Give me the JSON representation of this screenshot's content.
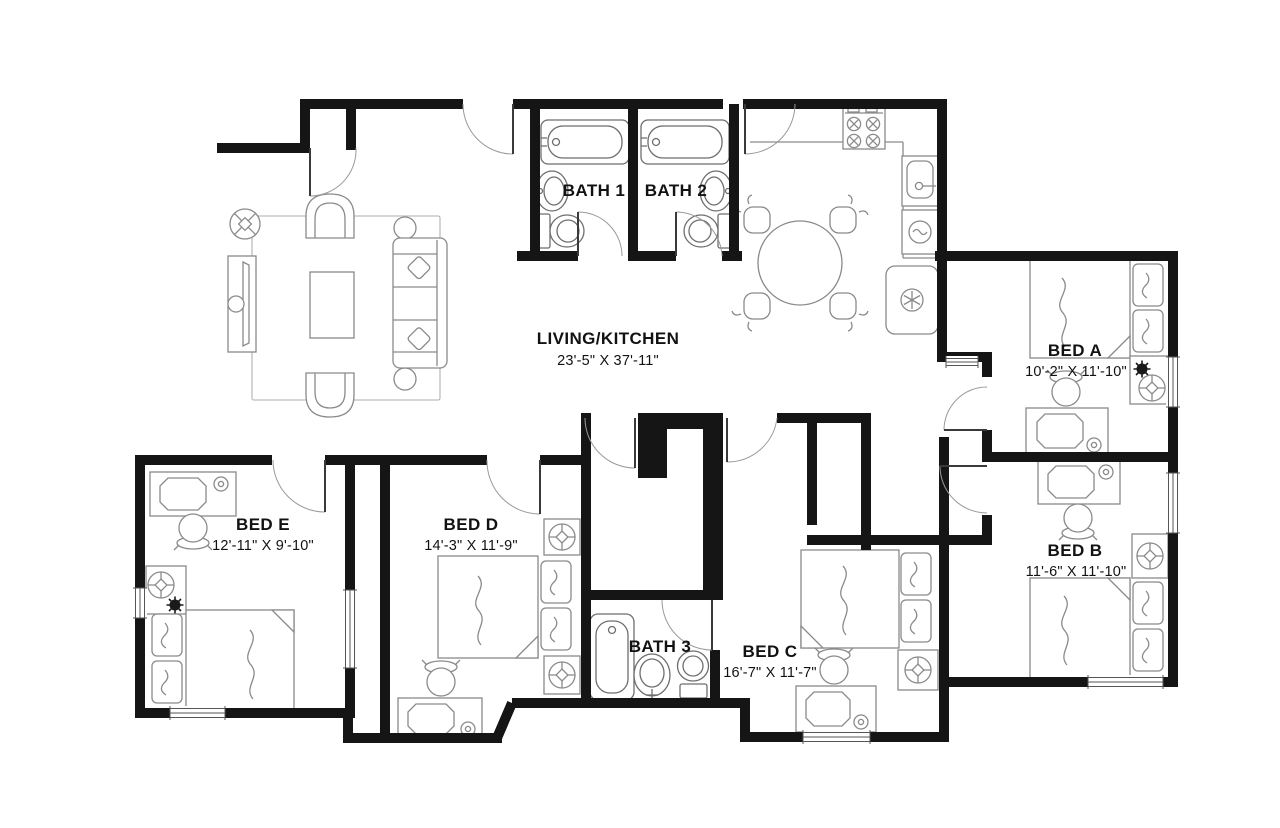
{
  "document": {
    "type": "floor-plan",
    "units": "feet-inches"
  },
  "colors": {
    "background": "#ffffff",
    "walls": "#151515",
    "furniture_line": "#808080",
    "fixture_line": "#6e6e6e",
    "door_arc": "#9a9a9a",
    "text": "#121212",
    "rug_line": "#b5b5b5"
  },
  "rooms": [
    {
      "id": "living-kitchen",
      "name": "LIVING/KITCHEN",
      "dimensions": "23'-5\" X 37'-11\"",
      "furniture": [
        "sofa",
        "armchair",
        "armchair",
        "coffee-table",
        "tv-console",
        "floor-lamp",
        "side-table",
        "side-table",
        "rug",
        "stove",
        "kitchen-sink",
        "dishwasher",
        "refrigerator",
        "dining-table",
        "dining-chair",
        "dining-chair",
        "dining-chair",
        "dining-chair"
      ]
    },
    {
      "id": "bath-1",
      "name": "BATH 1",
      "furniture": [
        "bathtub",
        "sink",
        "toilet"
      ]
    },
    {
      "id": "bath-2",
      "name": "BATH 2",
      "furniture": [
        "bathtub",
        "sink",
        "toilet"
      ]
    },
    {
      "id": "bath-3",
      "name": "BATH 3",
      "furniture": [
        "bathtub",
        "pedestal-sink",
        "toilet"
      ]
    },
    {
      "id": "bed-a",
      "name": "BED A",
      "dimensions": "10'-2\" X 11'-10\"",
      "furniture": [
        "bed",
        "pillow",
        "pillow",
        "nightstand",
        "ceiling-light",
        "plant",
        "desk",
        "desk-chair",
        "desk-lamp",
        "window"
      ]
    },
    {
      "id": "bed-b",
      "name": "BED B",
      "dimensions": "11'-6\" X 11'-10\"",
      "furniture": [
        "bed",
        "pillow",
        "pillow",
        "nightstand",
        "ceiling-light",
        "desk",
        "desk-chair",
        "desk-lamp",
        "window",
        "window"
      ]
    },
    {
      "id": "bed-c",
      "name": "BED C",
      "dimensions": "16'-7\" X 11'-7\"",
      "furniture": [
        "bed",
        "pillow",
        "pillow",
        "nightstand",
        "ceiling-light",
        "desk",
        "desk-chair",
        "desk-lamp",
        "window"
      ]
    },
    {
      "id": "bed-d",
      "name": "BED D",
      "dimensions": "14'-3\" X 11'-9\"",
      "furniture": [
        "bed",
        "pillow",
        "pillow",
        "nightstand",
        "nightstand",
        "ceiling-light",
        "ceiling-light",
        "desk",
        "desk-chair",
        "desk-lamp"
      ]
    },
    {
      "id": "bed-e",
      "name": "BED E",
      "dimensions": "12'-11\" X 9'-10\"",
      "furniture": [
        "bed",
        "pillow",
        "pillow",
        "nightstand",
        "ceiling-light",
        "plant",
        "desk",
        "desk-chair",
        "desk-lamp",
        "window",
        "window",
        "closet"
      ]
    }
  ]
}
